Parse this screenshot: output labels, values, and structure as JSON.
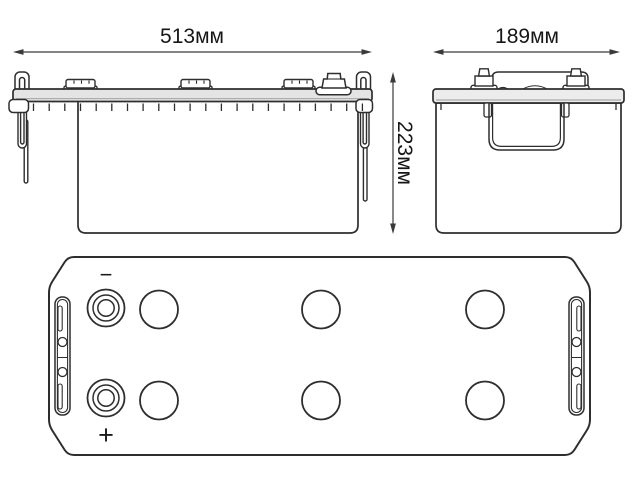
{
  "diagram": {
    "type": "battery-dimension-drawing",
    "views": {
      "front": {
        "width_label": "513мм"
      },
      "side": {
        "depth_label": "189мм"
      },
      "height_label": "223мм",
      "top": {
        "negative_label": "−",
        "positive_label": "+",
        "vent_count": 6
      }
    },
    "colors": {
      "line": "#2e2e2e",
      "dimension_line": "#3a3a3a",
      "lid_fill": "#e4e4e4",
      "background": "#ffffff"
    }
  }
}
